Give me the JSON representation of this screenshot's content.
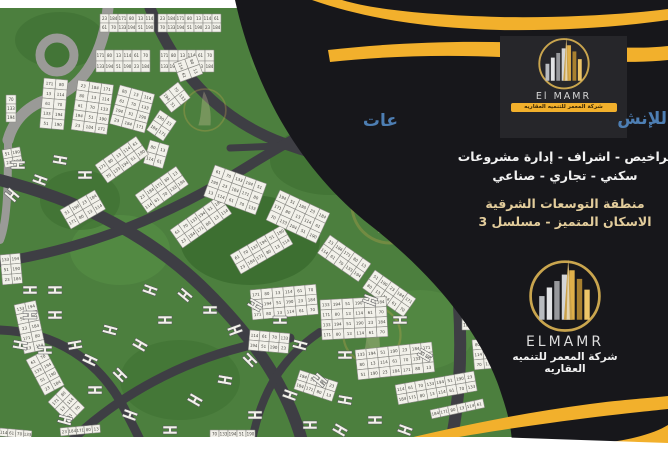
{
  "flyer": {
    "brand": {
      "name_en": "ELMAMR",
      "name_en_top": "El MAMR",
      "name_ar": "شركة المعمر للتنميه العقاريه"
    },
    "headline": {
      "right_fragment": "للإنش",
      "left_fragment": "عات"
    },
    "services_line1": "تراخيص - اشراف - إدارة مشروعات",
    "services_line2": "سكني - تجاري - صناعي",
    "location_line1": "منطقة التوسعات الشرقية",
    "location_line2": "الاسكان المتميز - مسلسل 3",
    "colors": {
      "panel": "#17171b",
      "gold": "#f2b02c",
      "blue": "#4d7eb3",
      "pale_gold_text": "#e3cd9c",
      "logo_box": "#26262a"
    },
    "map": {
      "description": "master plan site map with numbered plots",
      "colors": {
        "green": "#4c7f3e",
        "green_dark": "#3a6b2e",
        "green_light": "#578f46",
        "road": "#3e3e44",
        "road_light": "#9a9a97",
        "plot": "#f2f1ea",
        "plot_border": "#8a8a85",
        "plot_text": "#44443f",
        "watermark_ring": "#c9a84c",
        "watermark_sail": "#d8c9a2"
      }
    }
  }
}
